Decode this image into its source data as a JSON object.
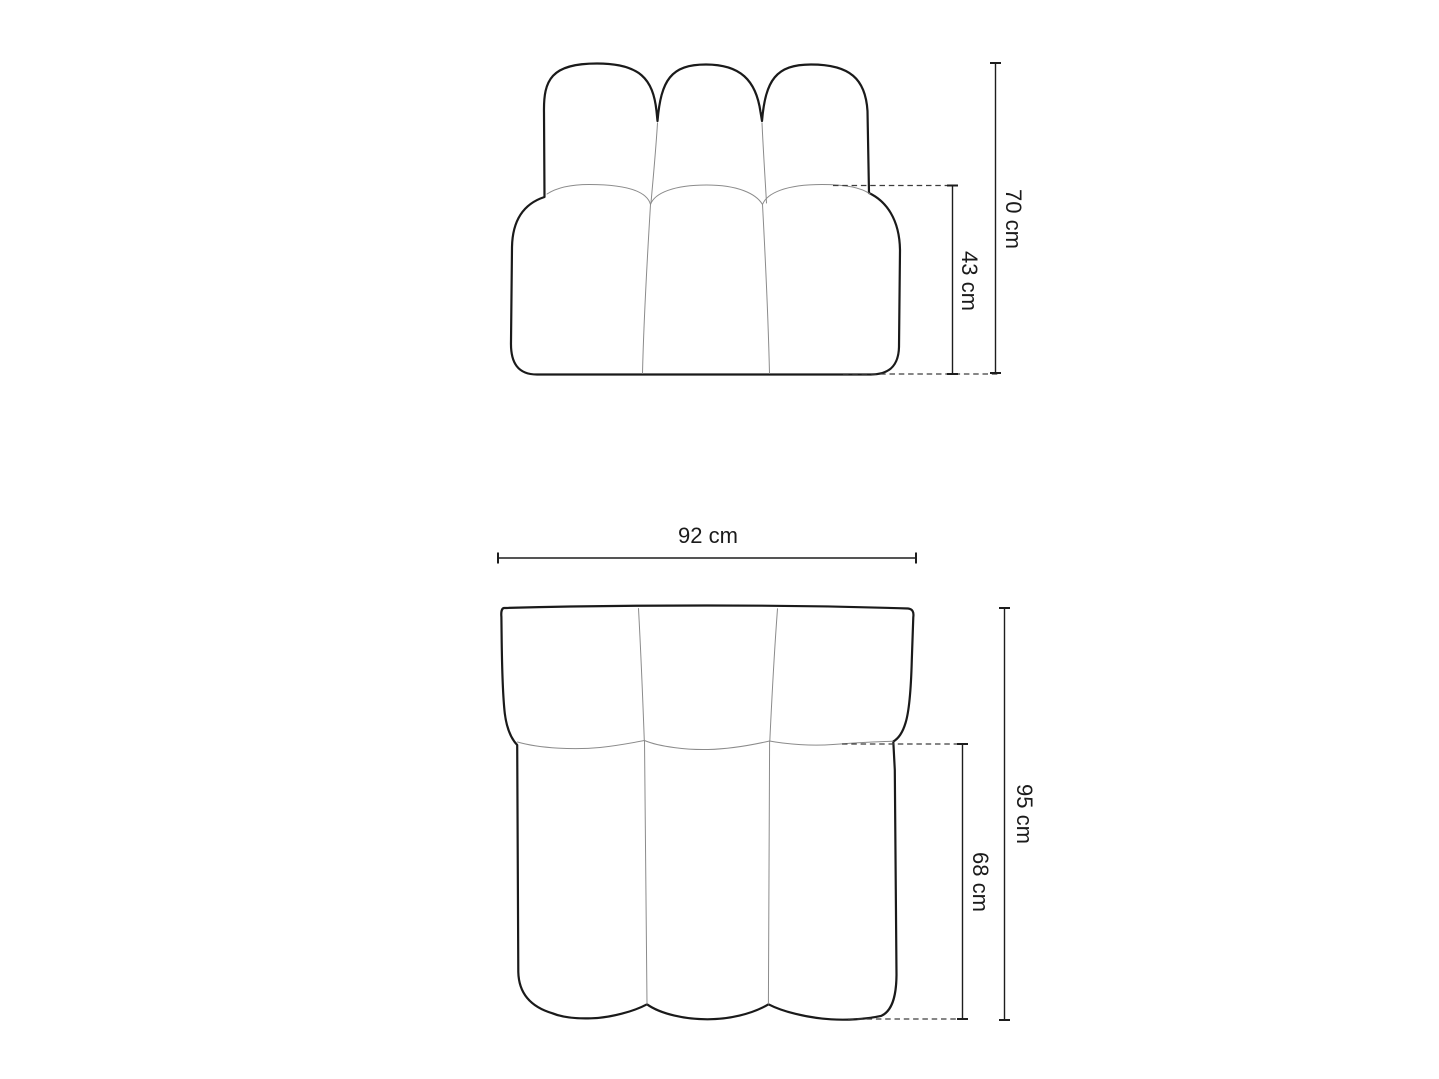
{
  "diagram": {
    "dimensions": {
      "front_total_height": "70 cm",
      "front_seat_height": "43 cm",
      "top_width": "92 cm",
      "top_total_depth": "95 cm",
      "top_seat_depth": "68 cm"
    },
    "colors": {
      "background": "#ffffff",
      "outline": "#1a1a1a",
      "seam": "#8b8b8b",
      "dimension_line": "#1d1d1d",
      "text": "#1b1b1b"
    }
  }
}
